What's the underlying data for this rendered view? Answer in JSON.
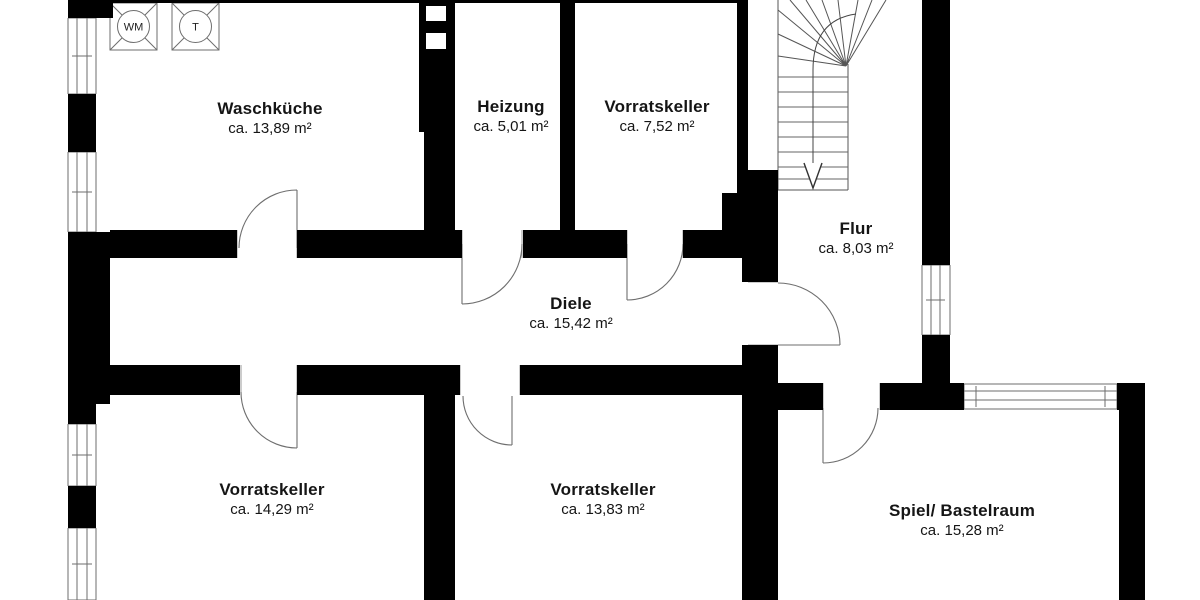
{
  "rooms": [
    {
      "id": "waschkueche",
      "name": "Waschküche",
      "area": "ca. 13,89 m²"
    },
    {
      "id": "heizung",
      "name": "Heizung",
      "area": "ca. 5,01 m²"
    },
    {
      "id": "vorratskeller-1",
      "name": "Vorratskeller",
      "area": "ca. 7,52 m²"
    },
    {
      "id": "flur",
      "name": "Flur",
      "area": "ca. 8,03 m²"
    },
    {
      "id": "diele",
      "name": "Diele",
      "area": "ca. 15,42 m²"
    },
    {
      "id": "vorratskeller-2",
      "name": "Vorratskeller",
      "area": "ca. 14,29 m²"
    },
    {
      "id": "vorratskeller-3",
      "name": "Vorratskeller",
      "area": "ca. 13,83 m²"
    },
    {
      "id": "spiel-bastelraum",
      "name": "Spiel/ Bastelraum",
      "area": "ca. 15,28 m²"
    }
  ],
  "appliances": [
    {
      "id": "washing-machine",
      "label": "WM"
    },
    {
      "id": "dryer",
      "label": "T"
    }
  ],
  "colors": {
    "wall": "#000000",
    "symbol_line": "#6e6e6e",
    "text": "#151515",
    "background": "#ffffff"
  }
}
